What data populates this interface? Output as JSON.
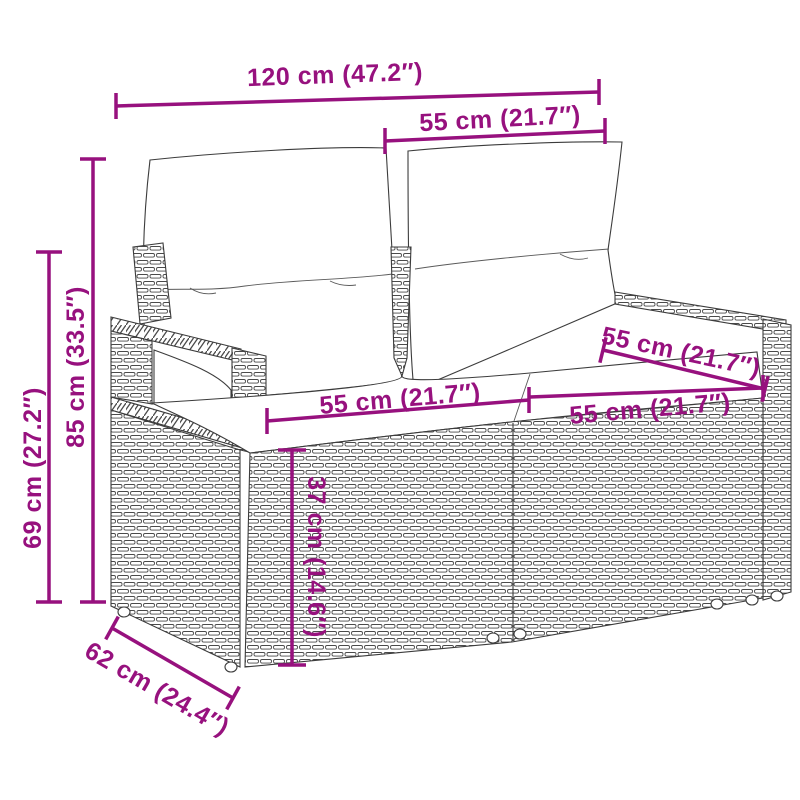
{
  "figure": {
    "kind": "product-dimension-diagram",
    "subject": "poly-rattan 2-seater garden sofa with back and seat cushions",
    "accent_color": "#97117e",
    "line_art_color": "#3c3c3c",
    "background_color": "#ffffff"
  },
  "dimensions": [
    {
      "id": "overall-width",
      "label": "120 cm (47.2″)"
    },
    {
      "id": "backrest-width",
      "label": "55 cm (21.7″)"
    },
    {
      "id": "total-height",
      "label": "85 cm (33.5″)"
    },
    {
      "id": "armrest-height",
      "label": "69 cm (27.2″)"
    },
    {
      "id": "seat-width-left",
      "label": "55 cm (21.7″)"
    },
    {
      "id": "seat-depth-right",
      "label": "55 cm (21.7″)"
    },
    {
      "id": "seat-width-right",
      "label": "55 cm (21.7″)"
    },
    {
      "id": "seat-height",
      "label": "37 cm (14.6″)"
    },
    {
      "id": "depth",
      "label": "62 cm (24.4″)"
    }
  ]
}
